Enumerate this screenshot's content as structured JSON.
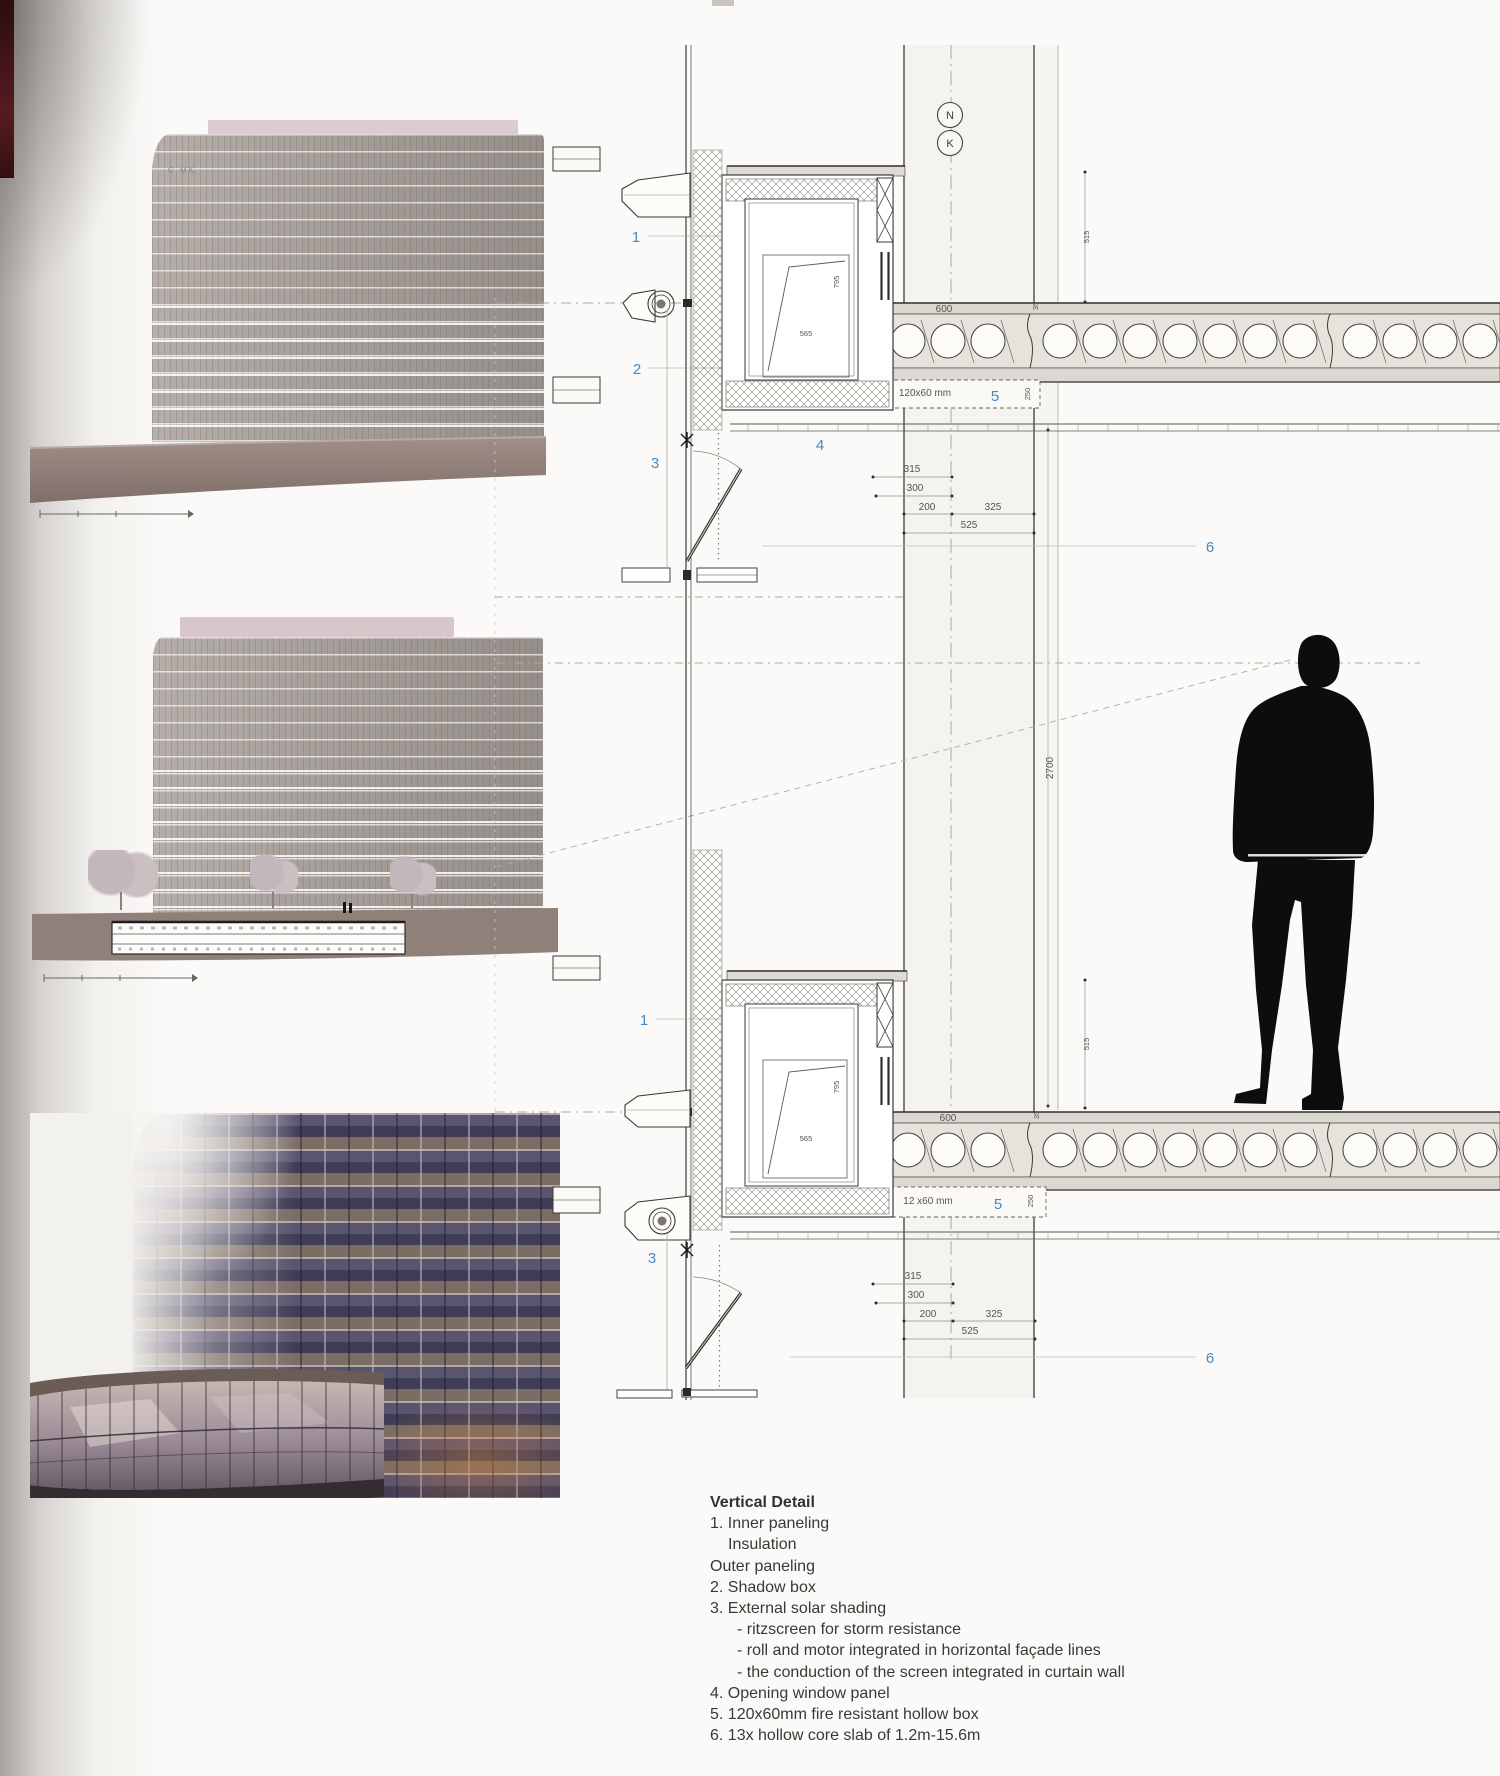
{
  "page": {
    "background": "#fbfaf8"
  },
  "legend": {
    "title": "Vertical Detail",
    "lines": [
      "1. Inner paneling",
      "Insulation",
      "Outer paneling",
      "2. Shadow box",
      "3. External solar shading",
      "- ritzscreen for storm resistance",
      "- roll and motor integrated in horizontal façade lines",
      "- the conduction of the screen integrated in curtain wall",
      "4. Opening window panel",
      "5. 120x60mm fire resistant hollow box",
      "6. 13x hollow core slab of 1.2m-15.6m"
    ]
  },
  "drawing": {
    "callout_color": "#4489c4",
    "grid_bubble_top": "N",
    "grid_bubble_bottom": "K",
    "floor_height_dim": "2700",
    "upper": {
      "c1": "1",
      "c2": "2",
      "c3": "3",
      "c4": "4",
      "c5": "5",
      "c6": "6",
      "slab_span": "600",
      "slab_joint": "35",
      "firebox": "120x60 mm",
      "firebox_depth": "250",
      "dim1": "315",
      "dim2": "300",
      "dim3": "200",
      "dim4": "325",
      "dim5": "525",
      "dim_right": "515",
      "box_w": "565",
      "box_h": "795"
    },
    "lower": {
      "c1": "1",
      "c3": "3",
      "c5": "5",
      "c6": "6",
      "slab_span": "600",
      "slab_joint": "35",
      "firebox": "12 x60 mm",
      "firebox_depth": "250",
      "dim1": "315",
      "dim2": "300",
      "dim3": "200",
      "dim4": "325",
      "dim5": "525",
      "dim_right": "515",
      "box_w": "565",
      "box_h": "795"
    }
  },
  "images": {
    "render_top": {
      "logo": "C MK",
      "palette": {
        "facade": "#a29a95",
        "plinth": "#8e7c74",
        "roof": "#dccbd0"
      }
    },
    "render_mid": {
      "palette": {
        "facade": "#a8a09b",
        "plinth": "#90807a",
        "roof": "#d9c6ca"
      }
    },
    "photo": {
      "palette": {
        "spandrel": "#7b6c64",
        "glass": "#45415c",
        "pavilion_glass": "#bfb0ac"
      }
    }
  }
}
